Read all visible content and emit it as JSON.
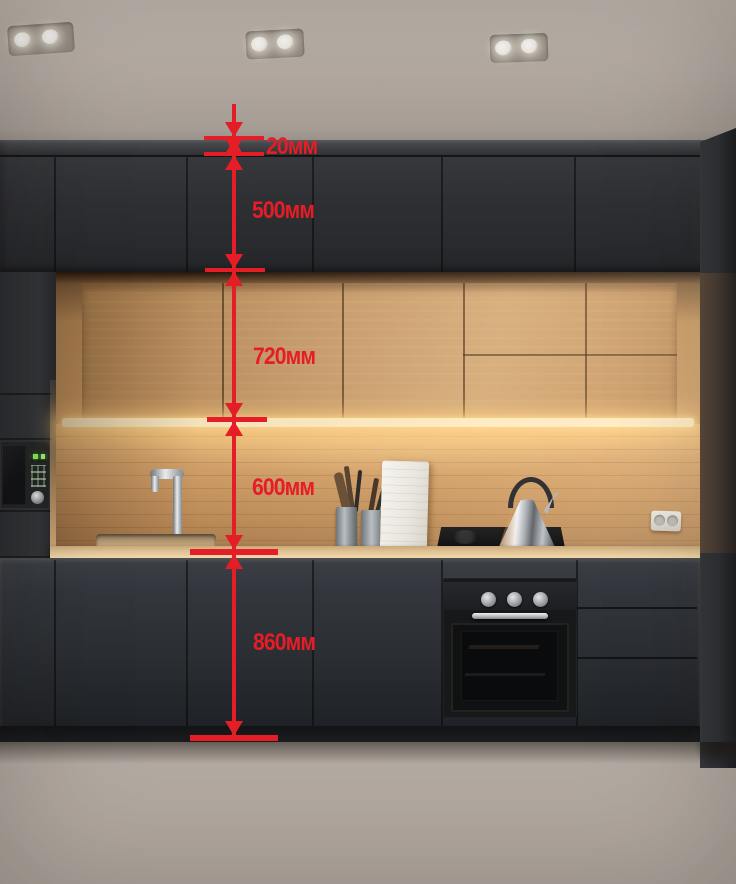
{
  "annotations": {
    "accent_color": "#e41d26",
    "unit": "мм",
    "labels": [
      {
        "id": "ceiling-gap",
        "text": "20мм",
        "value": 20
      },
      {
        "id": "upper-cabinet",
        "text": "500мм",
        "value": 500
      },
      {
        "id": "wall-cabinet",
        "text": "720мм",
        "value": 720
      },
      {
        "id": "backsplash",
        "text": "600мм",
        "value": 600
      },
      {
        "id": "base-cabinet",
        "text": "860мм",
        "value": 860
      }
    ]
  },
  "palette": {
    "ceiling": "#b3aaa2",
    "dark_cabinets": "#2f3236",
    "wood_cabinets": "#c99d6c",
    "backsplash": "#d8a56c",
    "led_strip": "#ffedc4",
    "countertop": "#e0c294",
    "floor": "#d8c6a2",
    "annotation_red": "#e41d26",
    "microwave_display_green": "#8ae55e"
  }
}
